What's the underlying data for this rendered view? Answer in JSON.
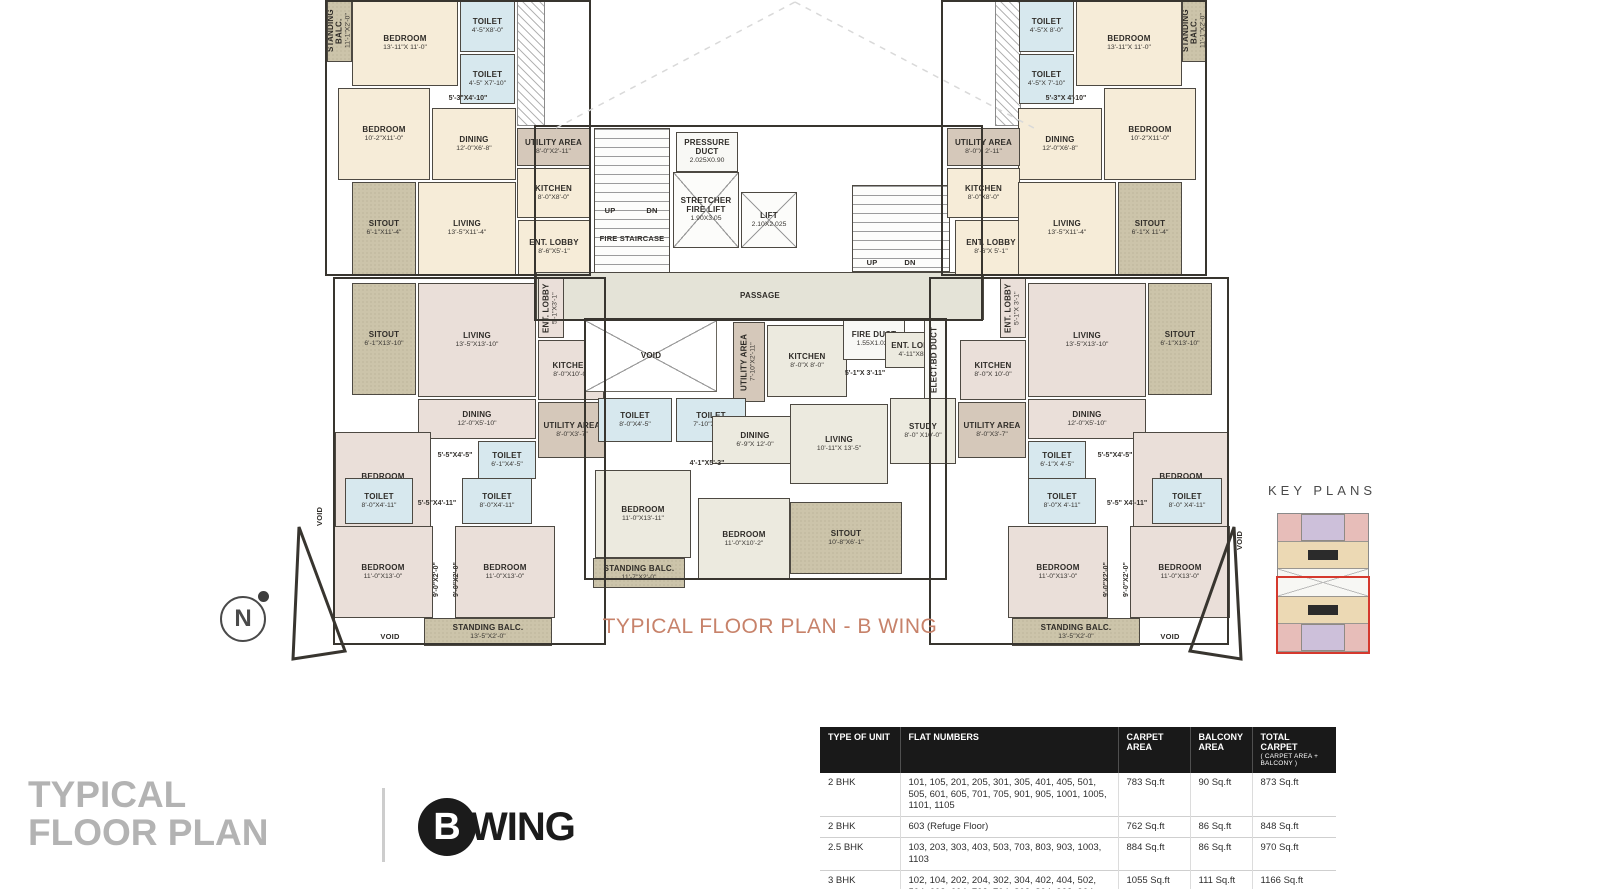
{
  "colors": {
    "accent_title": "#c7826a",
    "table_header_bg": "#191919",
    "keyplan_highlight_red": "#d5392e",
    "footer_title_gray": "#b3b3b3"
  },
  "plan": {
    "title": "TYPICAL FLOOR PLAN - B WING",
    "outlines": [
      [
        325,
        0,
        266,
        276
      ],
      [
        941,
        0,
        266,
        276
      ],
      [
        333,
        277,
        273,
        368
      ],
      [
        929,
        277,
        300,
        368
      ],
      [
        584,
        318,
        363,
        262
      ],
      [
        534,
        125,
        449,
        196
      ]
    ],
    "rooms": [
      {
        "n": "STANDING BALC.",
        "d": "11'-1\"X2'-0\"",
        "x": 327,
        "y": 0,
        "w": 25,
        "h": 62,
        "t": "balc",
        "v": 1
      },
      {
        "n": "BEDROOM",
        "d": "13'-11\"X 11'-0\"",
        "x": 352,
        "y": 0,
        "w": 106,
        "h": 86,
        "t": "cream"
      },
      {
        "n": "TOILET",
        "d": "4'-5\"X8'-0\"",
        "x": 460,
        "y": 0,
        "w": 55,
        "h": 52,
        "t": "wet"
      },
      {
        "n": "TOILET",
        "d": "4'-5\" X7'-10\"",
        "x": 460,
        "y": 54,
        "w": 55,
        "h": 50,
        "t": "wet"
      },
      {
        "n": "",
        "d": "",
        "x": 517,
        "y": 0,
        "w": 28,
        "h": 126,
        "t": "hatch"
      },
      {
        "n": "BEDROOM",
        "d": "10'-2\"X11'-0\"",
        "x": 338,
        "y": 88,
        "w": 92,
        "h": 92,
        "t": "cream"
      },
      {
        "n": "",
        "d": "5'-3\"X4'-10\"",
        "x": 432,
        "y": 92,
        "w": 72,
        "h": 14,
        "t": "label"
      },
      {
        "n": "DINING",
        "d": "12'-0\"X6'-8\"",
        "x": 432,
        "y": 108,
        "w": 84,
        "h": 72,
        "t": "cream"
      },
      {
        "n": "UTILITY AREA",
        "d": "8'-0\"X2'-11\"",
        "x": 517,
        "y": 128,
        "w": 73,
        "h": 38,
        "t": "util"
      },
      {
        "n": "KITCHEN",
        "d": "8'-0\"X8'-0\"",
        "x": 517,
        "y": 168,
        "w": 73,
        "h": 50,
        "t": "cream"
      },
      {
        "n": "SITOUT",
        "d": "6'-1\"X11'-4\"",
        "x": 352,
        "y": 182,
        "w": 64,
        "h": 93,
        "t": "balc"
      },
      {
        "n": "LIVING",
        "d": "13'-5\"X11'-4\"",
        "x": 418,
        "y": 182,
        "w": 98,
        "h": 93,
        "t": "cream"
      },
      {
        "n": "ENT. LOBBY",
        "d": "8'-6\"X5'-1\"",
        "x": 518,
        "y": 220,
        "w": 72,
        "h": 55,
        "t": "cream"
      },
      {
        "n": "",
        "d": "",
        "x": 594,
        "y": 128,
        "w": 76,
        "h": 145,
        "t": "stair"
      },
      {
        "n": "FIRE STAIRCASE",
        "d": "",
        "x": 588,
        "y": 226,
        "w": 88,
        "h": 26,
        "t": "label"
      },
      {
        "n": "UP",
        "d": "",
        "x": 598,
        "y": 206,
        "w": 24,
        "h": 10,
        "t": "label"
      },
      {
        "n": "DN",
        "d": "",
        "x": 640,
        "y": 206,
        "w": 24,
        "h": 10,
        "t": "label"
      },
      {
        "n": "PRESSURE DUCT",
        "d": "2.025X0.90",
        "x": 676,
        "y": 132,
        "w": 62,
        "h": 40,
        "t": "core"
      },
      {
        "n": "STRETCHER FIRE LIFT",
        "d": "1.90X3.05",
        "x": 673,
        "y": 172,
        "w": 66,
        "h": 76,
        "t": "lift"
      },
      {
        "n": "LIFT",
        "d": "2.10X2.025",
        "x": 741,
        "y": 192,
        "w": 56,
        "h": 56,
        "t": "lift"
      },
      {
        "n": "PASSAGE",
        "d": "",
        "x": 536,
        "y": 272,
        "w": 448,
        "h": 48,
        "t": "passage"
      },
      {
        "n": "",
        "d": "",
        "x": 852,
        "y": 185,
        "w": 98,
        "h": 87,
        "t": "stair"
      },
      {
        "n": "UP",
        "d": "",
        "x": 860,
        "y": 258,
        "w": 24,
        "h": 11,
        "t": "label"
      },
      {
        "n": "DN",
        "d": "",
        "x": 898,
        "y": 258,
        "w": 24,
        "h": 11,
        "t": "label"
      },
      {
        "n": "",
        "d": "",
        "x": 995,
        "y": 0,
        "w": 26,
        "h": 126,
        "t": "hatch"
      },
      {
        "n": "TOILET",
        "d": "4'-5\"X 8'-0\"",
        "x": 1019,
        "y": 0,
        "w": 55,
        "h": 52,
        "t": "wet"
      },
      {
        "n": "TOILET",
        "d": "4'-5\"X 7'-10\"",
        "x": 1019,
        "y": 54,
        "w": 55,
        "h": 50,
        "t": "wet"
      },
      {
        "n": "BEDROOM",
        "d": "13'-11\"X 11'-0\"",
        "x": 1076,
        "y": 0,
        "w": 106,
        "h": 86,
        "t": "cream"
      },
      {
        "n": "STANDING BALC.",
        "d": "11'-1\"X2'-0\"",
        "x": 1182,
        "y": 0,
        "w": 25,
        "h": 62,
        "t": "balc",
        "v": 1
      },
      {
        "n": "BEDROOM",
        "d": "10'-2\"X11'-0\"",
        "x": 1104,
        "y": 88,
        "w": 92,
        "h": 92,
        "t": "cream"
      },
      {
        "n": "",
        "d": "5'-3\"X 4'-10\"",
        "x": 1030,
        "y": 92,
        "w": 72,
        "h": 14,
        "t": "label"
      },
      {
        "n": "DINING",
        "d": "12'-0\"X6'-8\"",
        "x": 1018,
        "y": 108,
        "w": 84,
        "h": 72,
        "t": "cream"
      },
      {
        "n": "UTILITY AREA",
        "d": "8'-0\"X 2'-11\"",
        "x": 947,
        "y": 128,
        "w": 73,
        "h": 38,
        "t": "util"
      },
      {
        "n": "KITCHEN",
        "d": "8'-0\"X8'-0\"",
        "x": 947,
        "y": 168,
        "w": 73,
        "h": 50,
        "t": "cream"
      },
      {
        "n": "ENT. LOBBY",
        "d": "8'-6\"X 5'-1\"",
        "x": 955,
        "y": 220,
        "w": 72,
        "h": 55,
        "t": "cream"
      },
      {
        "n": "SITOUT",
        "d": "6'-1\"X 11'-4\"",
        "x": 1118,
        "y": 182,
        "w": 64,
        "h": 93,
        "t": "balc"
      },
      {
        "n": "LIVING",
        "d": "13'-5\"X11'-4\"",
        "x": 1018,
        "y": 182,
        "w": 98,
        "h": 93,
        "t": "cream"
      },
      {
        "n": "SITOUT",
        "d": "6'-1\"X13'-10\"",
        "x": 352,
        "y": 283,
        "w": 64,
        "h": 112,
        "t": "balc"
      },
      {
        "n": "LIVING",
        "d": "13'-5\"X13'-10\"",
        "x": 418,
        "y": 283,
        "w": 118,
        "h": 114,
        "t": "pink"
      },
      {
        "n": "ENT. LOBBY",
        "d": "5'-1\"X3'-1\"",
        "x": 538,
        "y": 278,
        "w": 26,
        "h": 60,
        "t": "pink",
        "v": 1
      },
      {
        "n": "KITCHEN",
        "d": "8'-0\"X10'-0\"",
        "x": 538,
        "y": 340,
        "w": 66,
        "h": 60,
        "t": "pink"
      },
      {
        "n": "DINING",
        "d": "12'-0\"X5'-10\"",
        "x": 418,
        "y": 399,
        "w": 118,
        "h": 40,
        "t": "pink"
      },
      {
        "n": "UTILITY AREA",
        "d": "8'-0\"X3'-7\"",
        "x": 538,
        "y": 402,
        "w": 68,
        "h": 56,
        "t": "util"
      },
      {
        "n": "BEDROOM",
        "d": "11'-0\"X10'-0\"",
        "x": 335,
        "y": 432,
        "w": 96,
        "h": 98,
        "t": "pink"
      },
      {
        "n": "",
        "d": "5'-5\"X4'-5\"",
        "x": 428,
        "y": 450,
        "w": 54,
        "h": 12,
        "t": "label"
      },
      {
        "n": "TOILET",
        "d": "6'-1\"X4'-5\"",
        "x": 478,
        "y": 441,
        "w": 58,
        "h": 38,
        "t": "wet"
      },
      {
        "n": "TOILET",
        "d": "8'-0\"X4'-11\"",
        "x": 345,
        "y": 478,
        "w": 68,
        "h": 46,
        "t": "wet"
      },
      {
        "n": "",
        "d": "5'-5\"X4'-11\"",
        "x": 408,
        "y": 498,
        "w": 58,
        "h": 12,
        "t": "label"
      },
      {
        "n": "TOILET",
        "d": "8'-0\"X4'-11\"",
        "x": 462,
        "y": 478,
        "w": 70,
        "h": 46,
        "t": "wet"
      },
      {
        "n": "VOID",
        "d": "",
        "x": 312,
        "y": 490,
        "w": 16,
        "h": 52,
        "t": "label",
        "v": 1
      },
      {
        "n": "BEDROOM",
        "d": "11'-0\"X13'-0\"",
        "x": 333,
        "y": 526,
        "w": 100,
        "h": 92,
        "t": "pink"
      },
      {
        "n": "",
        "d": "9'-0\"X2'-0\"",
        "x": 428,
        "y": 545,
        "w": 18,
        "h": 70,
        "t": "label",
        "v": 1
      },
      {
        "n": "",
        "d": "9'-0\"X2'-0\"",
        "x": 448,
        "y": 545,
        "w": 18,
        "h": 70,
        "t": "label",
        "v": 1
      },
      {
        "n": "BEDROOM",
        "d": "11'-0\"X13'-0\"",
        "x": 455,
        "y": 526,
        "w": 100,
        "h": 92,
        "t": "pink"
      },
      {
        "n": "VOID",
        "d": "",
        "x": 350,
        "y": 630,
        "w": 80,
        "h": 14,
        "t": "label"
      },
      {
        "n": "STANDING BALC.",
        "d": "13'-5\"X2'-0\"",
        "x": 424,
        "y": 618,
        "w": 128,
        "h": 28,
        "t": "balc"
      },
      {
        "n": "VOID",
        "d": "",
        "x": 585,
        "y": 320,
        "w": 132,
        "h": 72,
        "t": "void"
      },
      {
        "n": "UTILITY AREA",
        "d": "7'-10\"X2'-11\"",
        "x": 733,
        "y": 322,
        "w": 32,
        "h": 80,
        "t": "util",
        "v": 1
      },
      {
        "n": "KITCHEN",
        "d": "8'-0\"X 8'-0\"",
        "x": 767,
        "y": 325,
        "w": 80,
        "h": 72,
        "t": "gray"
      },
      {
        "n": "FIRE DUCT",
        "d": "1.55X1.025",
        "x": 843,
        "y": 318,
        "w": 62,
        "h": 42,
        "t": "core"
      },
      {
        "n": "ENT. LOBBY",
        "d": "4'-11\"X8'-0\"",
        "x": 885,
        "y": 332,
        "w": 62,
        "h": 36,
        "t": "gray"
      },
      {
        "n": "",
        "d": "5'-1\"X 3'-11\"",
        "x": 832,
        "y": 368,
        "w": 66,
        "h": 12,
        "t": "label"
      },
      {
        "n": "ELECT.BD DUCT",
        "d": "",
        "x": 924,
        "y": 320,
        "w": 22,
        "h": 80,
        "t": "core",
        "v": 1
      },
      {
        "n": "TOILET",
        "d": "8'-0\"X4'-5\"",
        "x": 598,
        "y": 398,
        "w": 74,
        "h": 44,
        "t": "wet"
      },
      {
        "n": "TOILET",
        "d": "7'-10\"X4'-5\"",
        "x": 676,
        "y": 398,
        "w": 70,
        "h": 44,
        "t": "wet"
      },
      {
        "n": "DINING",
        "d": "6'-9\"X 12'-0\"",
        "x": 712,
        "y": 416,
        "w": 86,
        "h": 48,
        "t": "gray"
      },
      {
        "n": "LIVING",
        "d": "10'-11\"X 13'-5\"",
        "x": 790,
        "y": 404,
        "w": 98,
        "h": 80,
        "t": "gray"
      },
      {
        "n": "STUDY",
        "d": "8'-0\" X10'-0\"",
        "x": 890,
        "y": 398,
        "w": 66,
        "h": 66,
        "t": "gray"
      },
      {
        "n": "",
        "d": "4'-1\"X5'-3\"",
        "x": 676,
        "y": 458,
        "w": 62,
        "h": 12,
        "t": "label"
      },
      {
        "n": "BEDROOM",
        "d": "11'-0\"X13'-11\"",
        "x": 595,
        "y": 470,
        "w": 96,
        "h": 88,
        "t": "gray"
      },
      {
        "n": "BEDROOM",
        "d": "11'-0\"X10'-2\"",
        "x": 698,
        "y": 498,
        "w": 92,
        "h": 82,
        "t": "gray"
      },
      {
        "n": "SITOUT",
        "d": "10'-8\"X6'-1\"",
        "x": 790,
        "y": 502,
        "w": 112,
        "h": 72,
        "t": "balc"
      },
      {
        "n": "STANDING BALC.",
        "d": "11'-7\"X2'-0\"",
        "x": 593,
        "y": 558,
        "w": 92,
        "h": 30,
        "t": "balc"
      },
      {
        "n": "ENT. LOBBY",
        "d": "5'-1\"X 3'-1\"",
        "x": 1000,
        "y": 278,
        "w": 26,
        "h": 60,
        "t": "pink",
        "v": 1
      },
      {
        "n": "LIVING",
        "d": "13'-5\"X13'-10\"",
        "x": 1028,
        "y": 283,
        "w": 118,
        "h": 114,
        "t": "pink"
      },
      {
        "n": "SITOUT",
        "d": "6'-1\"X13'-10\"",
        "x": 1148,
        "y": 283,
        "w": 64,
        "h": 112,
        "t": "balc"
      },
      {
        "n": "KITCHEN",
        "d": "8'-0\"X 10'-0\"",
        "x": 960,
        "y": 340,
        "w": 66,
        "h": 60,
        "t": "pink"
      },
      {
        "n": "DINING",
        "d": "12'-0\"X5'-10\"",
        "x": 1028,
        "y": 399,
        "w": 118,
        "h": 40,
        "t": "pink"
      },
      {
        "n": "UTILITY AREA",
        "d": "8'-0\"X3'-7\"",
        "x": 958,
        "y": 402,
        "w": 68,
        "h": 56,
        "t": "util"
      },
      {
        "n": "BEDROOM",
        "d": "11'-0\"X10'-0\"",
        "x": 1133,
        "y": 432,
        "w": 96,
        "h": 98,
        "t": "pink"
      },
      {
        "n": "TOILET",
        "d": "6'-1\"X 4'-5\"",
        "x": 1028,
        "y": 441,
        "w": 58,
        "h": 38,
        "t": "wet"
      },
      {
        "n": "",
        "d": "5'-5\"X4'-5\"",
        "x": 1088,
        "y": 450,
        "w": 54,
        "h": 12,
        "t": "label"
      },
      {
        "n": "TOILET",
        "d": "8'-0\"X 4'-11\"",
        "x": 1028,
        "y": 478,
        "w": 68,
        "h": 46,
        "t": "wet"
      },
      {
        "n": "",
        "d": "5'-5\" X4'-11\"",
        "x": 1098,
        "y": 498,
        "w": 58,
        "h": 12,
        "t": "label"
      },
      {
        "n": "TOILET",
        "d": "8'-0\" X4'-11\"",
        "x": 1152,
        "y": 478,
        "w": 70,
        "h": 46,
        "t": "wet"
      },
      {
        "n": "BEDROOM",
        "d": "11'-0\"X13'-0\"",
        "x": 1008,
        "y": 526,
        "w": 100,
        "h": 92,
        "t": "pink"
      },
      {
        "n": "",
        "d": "9'-0\"X2'-0\"",
        "x": 1098,
        "y": 545,
        "w": 18,
        "h": 70,
        "t": "label",
        "v": 1
      },
      {
        "n": "",
        "d": "9'-0\"X2'-0\"",
        "x": 1118,
        "y": 545,
        "w": 18,
        "h": 70,
        "t": "label",
        "v": 1
      },
      {
        "n": "BEDROOM",
        "d": "11'-0\"X13'-0\"",
        "x": 1130,
        "y": 526,
        "w": 100,
        "h": 92,
        "t": "pink"
      },
      {
        "n": "STANDING BALC.",
        "d": "13'-5\"X2'-0\"",
        "x": 1012,
        "y": 618,
        "w": 128,
        "h": 28,
        "t": "balc"
      },
      {
        "n": "VOID",
        "d": "",
        "x": 1130,
        "y": 630,
        "w": 80,
        "h": 14,
        "t": "label"
      },
      {
        "n": "VOID",
        "d": "",
        "x": 1232,
        "y": 514,
        "w": 16,
        "h": 52,
        "t": "label",
        "v": 1
      }
    ]
  },
  "north": {
    "label": "N"
  },
  "key_plans": {
    "title": "KEY PLANS"
  },
  "footer": {
    "title_line1": "TYPICAL",
    "title_line2": "FLOOR PLAN",
    "wing_letter": "B",
    "wing_word": "WING"
  },
  "table": {
    "headers": [
      "TYPE OF UNIT",
      "FLAT NUMBERS",
      "CARPET AREA",
      "BALCONY AREA",
      "TOTAL CARPET"
    ],
    "total_carpet_sub": "( CARPET AREA + BALCONY )",
    "col_widths": [
      80,
      218,
      72,
      62,
      84
    ],
    "rows": [
      [
        "2 BHK",
        "101, 105, 201, 205, 301, 305, 401, 405, 501, 505, 601, 605, 701, 705, 901, 905, 1001, 1005, 1101, 1105",
        "783 Sq.ft",
        "90 Sq.ft",
        "873 Sq.ft"
      ],
      [
        "2 BHK",
        "603 (Refuge Floor)",
        "762 Sq.ft",
        "86  Sq.ft",
        "848 Sq.ft"
      ],
      [
        "2.5 BHK",
        "103, 203, 303, 403, 503, 703, 803, 903, 1003, 1103",
        "884 Sq.ft",
        "86  Sq.ft",
        "970 Sq.ft"
      ],
      [
        "3 BHK",
        "102, 104, 202, 204, 302, 304, 402, 404, 502, 504, 602, 604, 702, 704, 802, 804, 902, 904, 1002, 1004, 1102, 1104",
        "1055 Sq.ft",
        "111 Sq.ft",
        "1166 Sq.ft"
      ]
    ]
  }
}
